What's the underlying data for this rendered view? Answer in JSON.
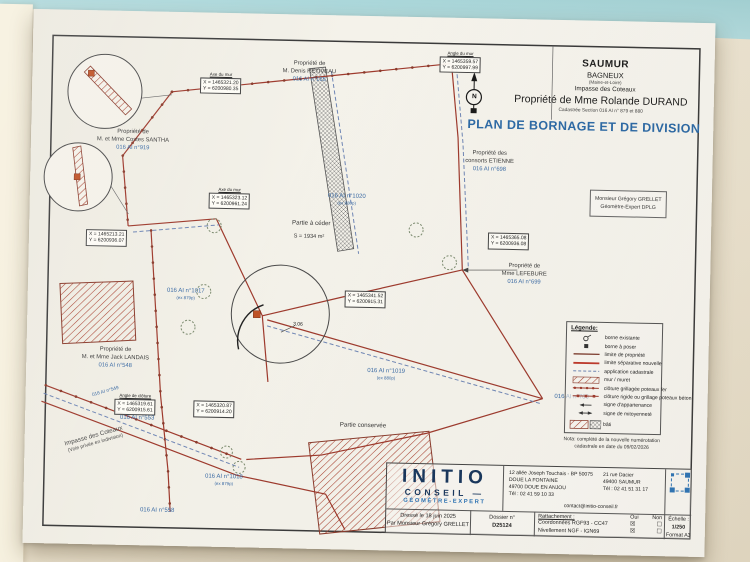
{
  "colors": {
    "teal_background": "#a6d4d7",
    "paper": "#f4f2ea",
    "boundary_red": "#9e3a2d",
    "cadastral_blue": "#6f86b5",
    "parcel_text_blue": "#3b6ba5",
    "title_blue": "#2d6aa6",
    "brand_navy": "#17365d",
    "brand_blue": "#2e75b6",
    "marker_orange": "#bf5226"
  },
  "header": {
    "commune": "SAUMUR",
    "lieu_dit": "BAGNEUX",
    "departement": "(Maine-et-Loire)",
    "adresse": "Impasse des Coteaux",
    "propriete": "Propriété de Mme Rolande DURAND",
    "cadastre": "Cadastrée Section 016 AI n° 879 et 880",
    "titre": "PLAN DE BORNAGE ET DE DIVISION",
    "north_label": "N"
  },
  "geometre_box": {
    "line1": "Monsieur Grégory GRELLET",
    "line2": "Géomètre-Expert DPLG"
  },
  "plan": {
    "owner_labels": [
      {
        "l1": "Propriété de",
        "l2": "M. Denis RETIVEAU",
        "num": "016 AI n°165"
      },
      {
        "l1": "Propriété de",
        "l2": "M. et Mme Costes SANTHA",
        "num": "016 AI n°919"
      },
      {
        "l1": "Propriété des",
        "l2": "consorts ETIENNE",
        "num": "016 AI n°698"
      },
      {
        "l1": "Propriété de",
        "l2": "Mme LEFEBURE",
        "num": "016 AI n°699"
      },
      {
        "l1": "Propriété de",
        "l2": "M. et Mme Jack LANDAIS",
        "num": "016 AI n°548"
      }
    ],
    "parcel_labels": [
      {
        "num": "016 AI n°1017",
        "ex": "(ex 879p)"
      },
      {
        "num": "016 AI n°1020",
        "ex": "(ex 880p)"
      },
      {
        "num": "016 AI n°1019",
        "ex": "(ex 880p)"
      },
      {
        "num": "016 AI n°1018",
        "ex": "(ex 879p)"
      },
      {
        "num": "016 AI n°700"
      },
      {
        "num": "016 AI n°553"
      },
      {
        "num": "016 AI n°558"
      },
      {
        "num": "016 AI n°549"
      }
    ],
    "zone_labels": {
      "partie_ceder": "Partie à céder",
      "surface": "S = 1934 m²",
      "partie_conservee": "Partie conservée"
    },
    "street": {
      "l1": "Impasse des Coteaux",
      "l2": "(Voie privée en indivision)"
    },
    "dimension": "3.06",
    "coordinate_boxes": [
      {
        "title": "Axe du mur",
        "x": "X = 1465321.20",
        "y": "Y = 6200980.35"
      },
      {
        "title": "Axe du mur",
        "x": "X = 1465323.12",
        "y": "Y = 6200961.24"
      },
      {
        "x": "X = 1465213.21",
        "y": "Y = 6200936.07"
      },
      {
        "x": "X = 1465365.08",
        "y": "Y = 6200936.08"
      },
      {
        "x": "X = 1465341.52",
        "y": "Y = 6200915.31"
      },
      {
        "title": "Angle de clôture",
        "x": "X = 1465319.61",
        "y": "Y = 6200915.61"
      },
      {
        "x": "X = 1465320.87",
        "y": "Y = 6200914.20"
      },
      {
        "title": "Angle du mur",
        "x": "X = 1465359.57",
        "y": "Y = 6200997.99"
      }
    ]
  },
  "legend": {
    "title": "Légende:",
    "items": [
      "borne existante",
      "borne à poser",
      "limite de propriété",
      "limite séparative nouvelle",
      "application cadastrale",
      "mur / muret",
      "clôture grillagée poteaux fer",
      "clôture rigide ou grillage poteaux béton",
      "signe d'appartenance",
      "signe de mitoyenneté",
      "bâti"
    ],
    "nota_line1": "Nota: complété de la nouvelle numérotation",
    "nota_line2": "cadastrale en date du 09/02/2026"
  },
  "titleblock": {
    "firm_name": "INITIO",
    "firm_line2": "CONSEIL —",
    "firm_line3": "GÉOMÈTRE-EXPERT",
    "dresse": "Dressé le 18 juin 2025",
    "dresse_par": "Par Monsieur Grégory GRELLET",
    "dossier_label": "Dossier n°",
    "dossier_value": "D25124",
    "address1": {
      "l1": "12 allée Joseph Touchais - BP 50075",
      "l2": "DOUE LA FONTAINE",
      "l3": "49700 DOUE EN ANJOU",
      "l4": "Tél : 02 41 59 10 33"
    },
    "address2": {
      "l1": "21 rue Dacier",
      "l2": "49400 SAUMUR",
      "l3": "Tél : 02 41 51 31 17"
    },
    "email": "contact@initio-conseil.fr",
    "rattachement_label": "Rattachement :",
    "oui_label": "Oui",
    "non_label": "Non",
    "rows": [
      {
        "label": "Coordonnées RGF93 - CC47",
        "oui": "☒",
        "non": "☐"
      },
      {
        "label": "Nivellement NGF - IGN69",
        "oui": "☒",
        "non": "☐"
      }
    ],
    "echelle_label": "Échelle :",
    "echelle_value": "1/250",
    "format_value": "Format A3"
  }
}
